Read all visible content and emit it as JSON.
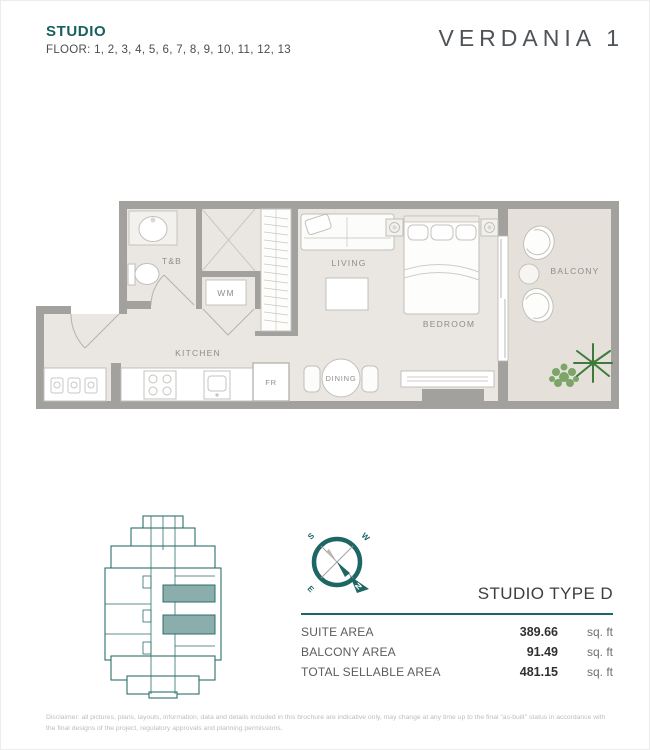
{
  "header": {
    "unit_type": "STUDIO",
    "floors": "FLOOR: 1, 2, 3, 4, 5, 6, 7, 8, 9, 10, 11, 12, 13",
    "brand": "VERDANIA 1"
  },
  "floor_plan": {
    "rooms": {
      "tb": "T&B",
      "wm": "WM",
      "living": "LIVING",
      "bedroom": "BEDROOM",
      "balcony": "BALCONY",
      "kitchen": "KITCHEN",
      "fridge": "FR",
      "dining": "DINING"
    }
  },
  "compass": {
    "n": "N",
    "s": "S",
    "e": "E",
    "w": "W"
  },
  "details": {
    "type_title": "STUDIO TYPE D",
    "rows": [
      {
        "label": "SUITE AREA",
        "value": "389.66",
        "unit": "sq. ft"
      },
      {
        "label": "BALCONY AREA",
        "value": "91.49",
        "unit": "sq. ft"
      },
      {
        "label": "TOTAL SELLABLE AREA",
        "value": "481.15",
        "unit": "sq. ft"
      }
    ]
  },
  "colors": {
    "accent_teal": "#1d6663",
    "key_plan_highlight": "#8badab",
    "wall_gray": "#a3a19e",
    "floor_beige": "#eae6e1"
  },
  "disclaimer": "Disclaimer: all pictures, plans, layouts, information, data and details included in this brochure are indicative only, may change at any time up to the final \"as-built\" status in accordance with the final designs of the project, regulatory approvals and planning permissions."
}
